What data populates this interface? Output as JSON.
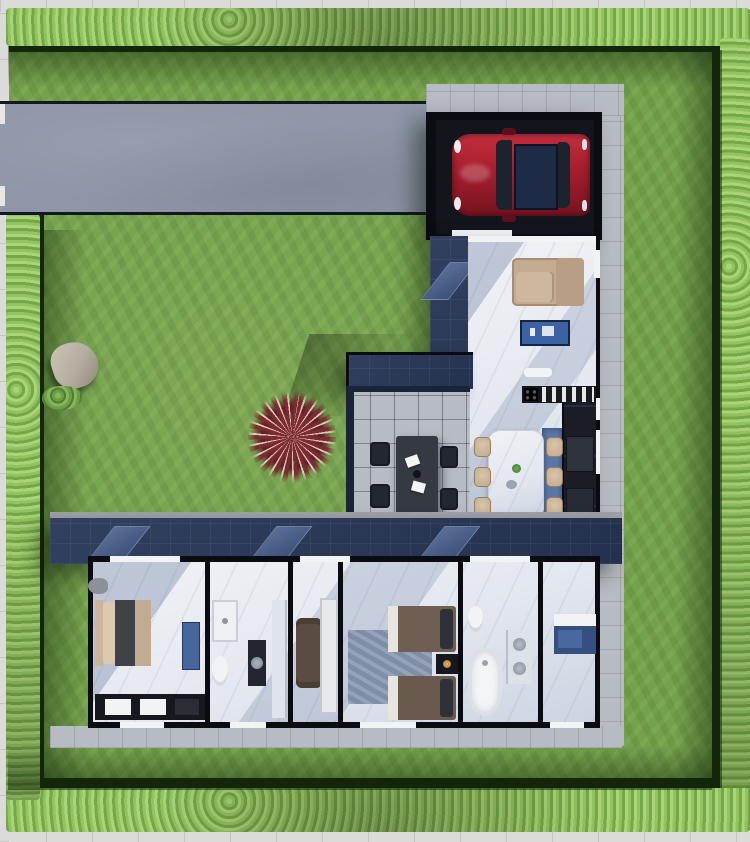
{
  "scene": {
    "kind": "top-down 3d architectural render, dollhouse cutaway floor plan",
    "site": {
      "lawn": "grass yard",
      "hedge_border_sides": [
        "top",
        "right",
        "bottom",
        "left"
      ],
      "sidewalk": "light concrete pavement around perimeter",
      "driveway": "wide concrete driveway from left edge to carport",
      "garden_features": [
        "stone-boulder",
        "small-shrub",
        "red-ornamental-grass"
      ]
    },
    "house": {
      "shape": "L-shaped single storey",
      "vehicle": {
        "type": "hatchback-car",
        "color_name": "red",
        "location": "carport",
        "detail": "dark sunroof, facing left"
      },
      "rooms": [
        {
          "name": "carport",
          "furniture": [
            "red-car"
          ]
        },
        {
          "name": "living-room",
          "furniture": [
            "beige-l-sofa",
            "blue-media-console",
            "wall-shelf"
          ]
        },
        {
          "name": "kitchen",
          "furniture": [
            "cooktop-counter",
            "dish-rack",
            "tall-dark-cabinets",
            "blue-runner"
          ]
        },
        {
          "name": "dining-room",
          "furniture": [
            "white-marble-table",
            "six-beige-chairs"
          ]
        },
        {
          "name": "covered-terrace",
          "roof": "tinted-glass-pergola",
          "furniture": [
            "dark-outdoor-table",
            "four-dark-chairs",
            "papers-on-table"
          ]
        },
        {
          "name": "master-bedroom",
          "furniture": [
            "double-bed",
            "blue-bench",
            "wardrobe",
            "side-chair"
          ]
        },
        {
          "name": "bathroom-1",
          "furniture": [
            "vanity-sink",
            "toilet",
            "basin-stand",
            "shower"
          ]
        },
        {
          "name": "dressing-room",
          "furniture": [
            "brown-armchair",
            "tall-white-wardrobe"
          ]
        },
        {
          "name": "bedroom-2",
          "furniture": [
            "single-bed-1",
            "single-bed-2",
            "nightstand-with-lamp",
            "area-rug"
          ]
        },
        {
          "name": "bathroom-2",
          "furniture": [
            "toilet",
            "freestanding-bathtub",
            "double-basin-counter"
          ]
        },
        {
          "name": "entry-hall",
          "furniture": [
            "blue-console-desk"
          ]
        }
      ]
    }
  },
  "colors": {
    "grass": "#74a14c",
    "hedge": "#93c361",
    "hedge-light": "#a9d477",
    "hedge-dark": "#76a747",
    "shadow-green": "#15250e",
    "driveway": "#8e96a7",
    "sidewalk": "#dbdbd9",
    "walkway": "#b7bbc2",
    "roof": "#24314e",
    "skylight": "#3c5078",
    "wall": "#0a0c11",
    "floor-a": "#f1f2f6",
    "floor-b": "#ccd4e2",
    "accent-blue": "#3c62a6",
    "rug-blue": "#5b77a6",
    "beige": "#c8b196",
    "car-red": "#b12231",
    "car-red-dark": "#7c1421",
    "wood-brown": "#63544a",
    "table-dark": "#343942",
    "plant-red": "#7d2a31",
    "stone": "#b5ad9f",
    "glass-blue": "rgba(74,110,180,0.55)"
  }
}
